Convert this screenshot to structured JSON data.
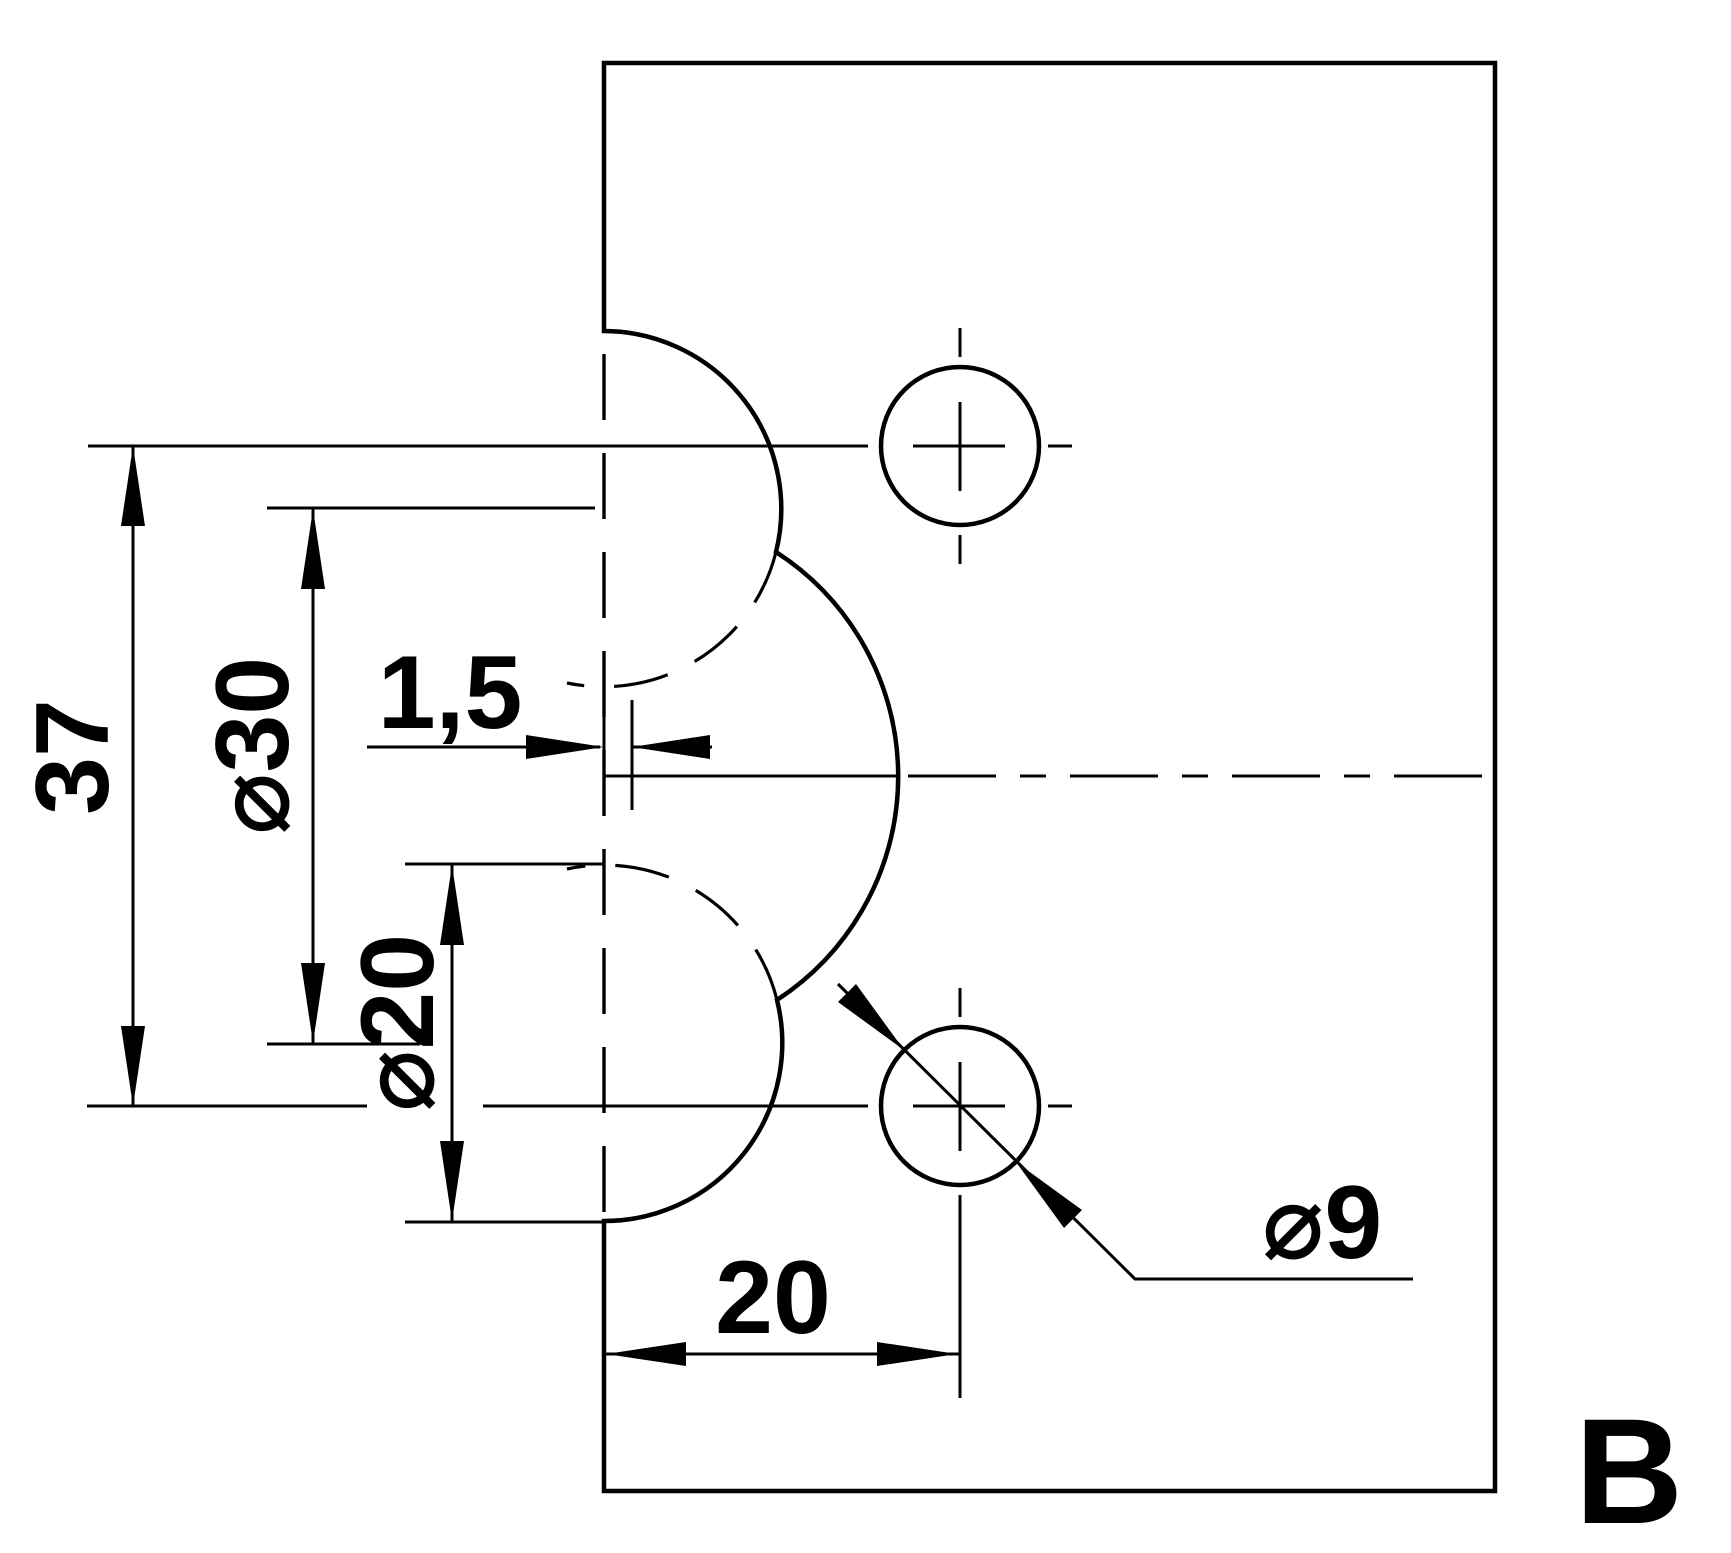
{
  "drawing": {
    "view_label": "B",
    "panel_fill": "#c8e2f6",
    "hole_fill": "#ffffff",
    "line_color": "#000000",
    "units": "mm",
    "dimensions": [
      {
        "id": "hole-spacing-vertical",
        "label": "37",
        "value": 37,
        "orientation": "vertical",
        "measures": "distance between the two drill hole centerlines"
      },
      {
        "id": "large-cutout-diameter",
        "label": "⌀30",
        "value": 30,
        "orientation": "vertical",
        "measures": "diameter of the large edge cutout circle"
      },
      {
        "id": "edge-offset",
        "label": "1,5",
        "value": 1.5,
        "orientation": "horizontal",
        "measures": "offset of large cutout center from glass edge"
      },
      {
        "id": "small-cutout-diameter",
        "label": "⌀20",
        "value": 20,
        "orientation": "vertical",
        "measures": "diameter of the small edge cutout circles"
      },
      {
        "id": "hole-edge-distance",
        "label": "20",
        "value": 20,
        "orientation": "horizontal",
        "measures": "drill hole center distance from glass edge"
      },
      {
        "id": "hole-diameter",
        "label": "⌀9",
        "value": 9,
        "orientation": "leader",
        "measures": "diameter of the two drill holes"
      }
    ]
  }
}
